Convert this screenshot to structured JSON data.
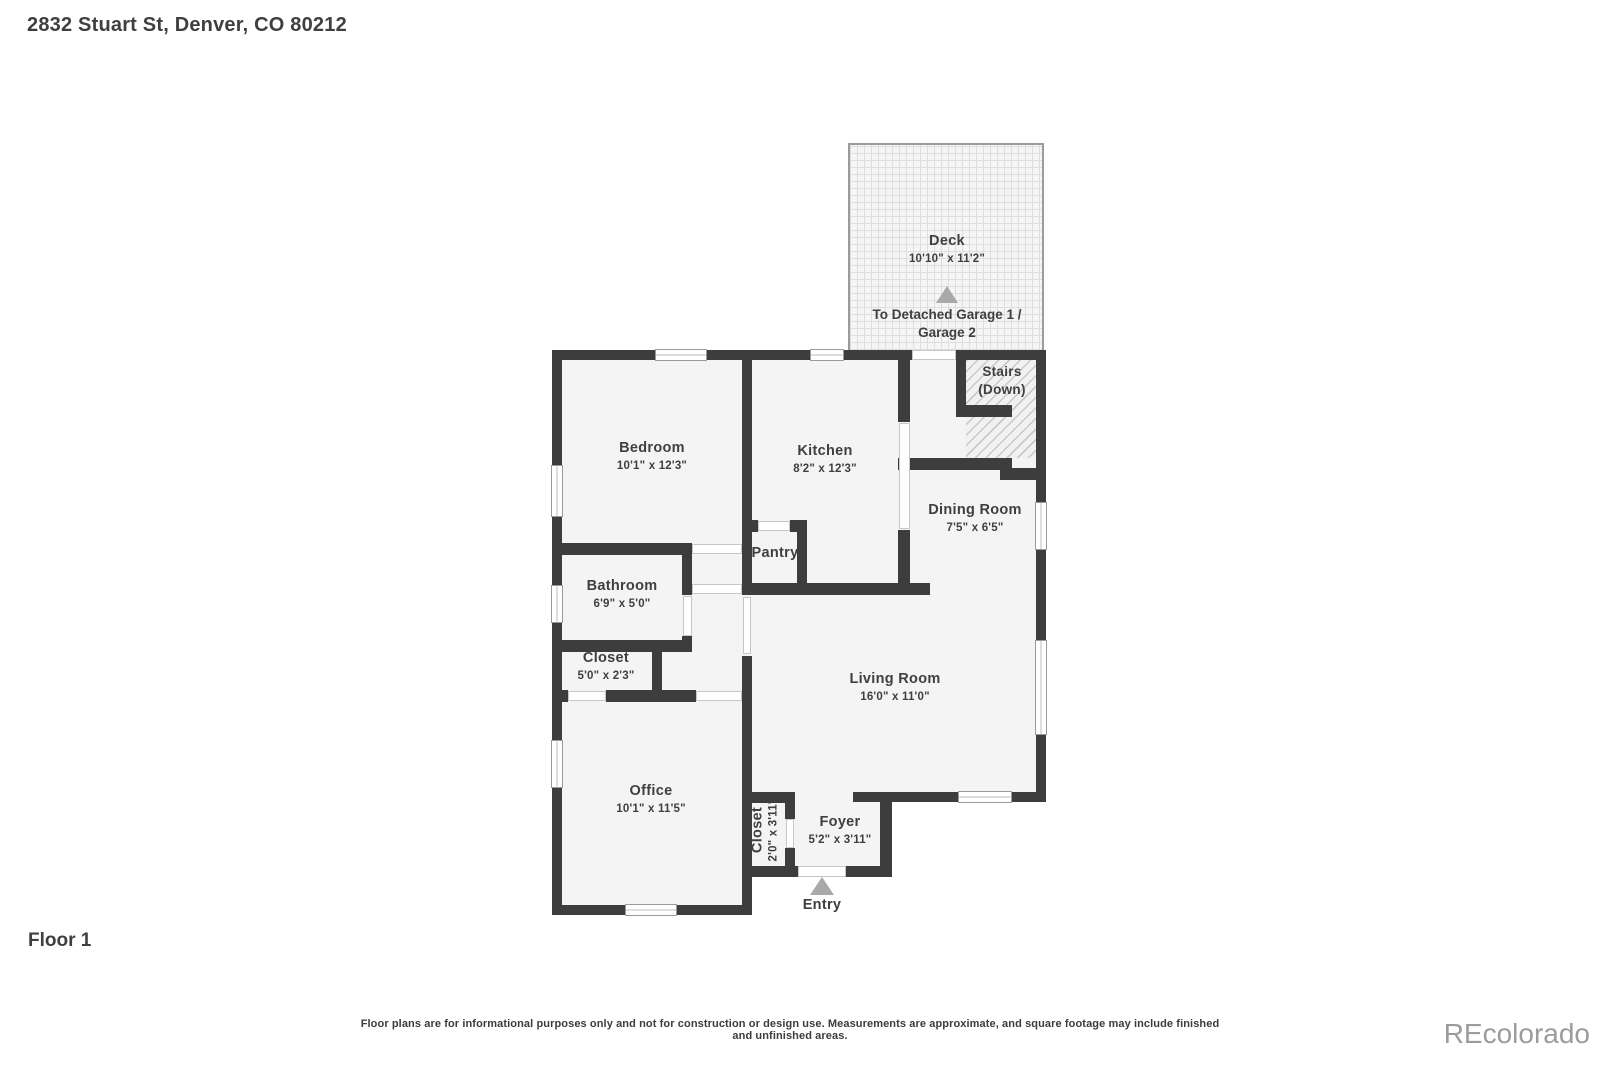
{
  "header": {
    "title": "2832 Stuart St, Denver, CO 80212"
  },
  "footer": {
    "floor_label": "Floor 1",
    "disclaimer": "Floor plans are for informational purposes only and not for construction or design use. Measurements are approximate, and square footage may include finished and unfinished areas.",
    "watermark": "REcolorado"
  },
  "rooms": {
    "deck": {
      "name": "Deck",
      "dims": "10'10\" x 11'2\""
    },
    "garage_note": {
      "line1": "To Detached Garage 1 /",
      "line2": "Garage 2"
    },
    "stairs": {
      "name": "Stairs",
      "sub": "(Down)"
    },
    "bedroom": {
      "name": "Bedroom",
      "dims": "10'1\" x 12'3\""
    },
    "kitchen": {
      "name": "Kitchen",
      "dims": "8'2\" x 12'3\""
    },
    "dining": {
      "name": "Dining Room",
      "dims": "7'5\" x 6'5\""
    },
    "pantry": {
      "name": "Pantry"
    },
    "bathroom": {
      "name": "Bathroom",
      "dims": "6'9\" x 5'0\""
    },
    "closet_hall": {
      "name": "Closet",
      "dims": "5'0\" x 2'3\""
    },
    "living": {
      "name": "Living Room",
      "dims": "16'0\" x 11'0\""
    },
    "office": {
      "name": "Office",
      "dims": "10'1\" x 11'5\""
    },
    "closet_entry": {
      "name": "Closet",
      "dims": "2'0\" x 3'11\""
    },
    "foyer": {
      "name": "Foyer",
      "dims": "5'2\" x 3'11\""
    },
    "entry": {
      "name": "Entry"
    }
  },
  "colors": {
    "wall": "#3d3d3d",
    "floor": "#f4f4f4",
    "text": "#3f3f3f",
    "triangle": "#a9a9a9",
    "hatch_line": "#c9c9c9",
    "deck_line": "#dedede",
    "window_border": "#9a9a9a",
    "opening_border": "#c6c6c6",
    "watermark": "#9c9c9c"
  }
}
